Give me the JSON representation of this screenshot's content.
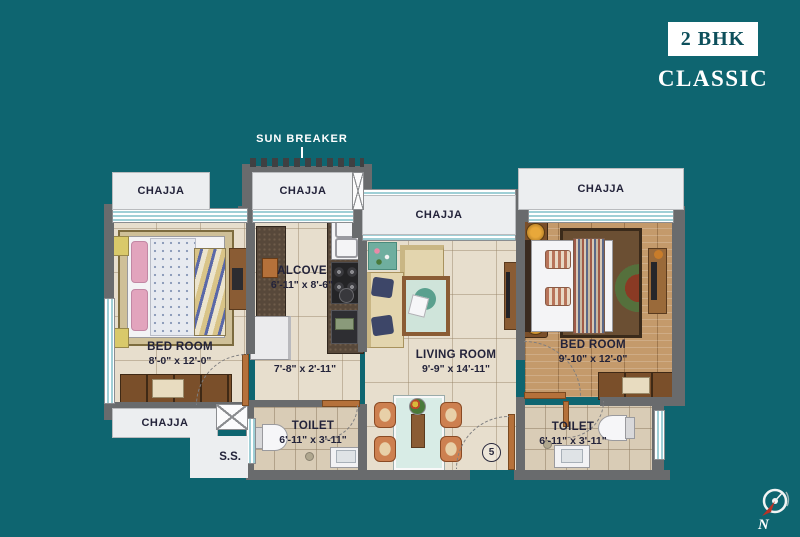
{
  "header": {
    "badge": "2 BHK",
    "subtitle": "CLASSIC"
  },
  "labels": {
    "chajja": "CHAJJA",
    "sun_breaker": "SUN BREAKER",
    "ss": "S.S.",
    "door_number": "5",
    "north": "N"
  },
  "rooms": {
    "bedroom_left": {
      "name": "BED ROOM",
      "size": "8'-0\" x 12'-0\""
    },
    "alcove": {
      "name": "ALCOVE",
      "size": "6'-11\" x 8'-6\""
    },
    "passage": {
      "size": "7'-8\" x 2'-11\""
    },
    "living_room": {
      "name": "LIVING ROOM",
      "size": "9'-9\" x 14'-11\""
    },
    "bedroom_right": {
      "name": "BED ROOM",
      "size": "9'-10\" x 12'-0\""
    },
    "toilet_left": {
      "name": "TOILET",
      "size": "6'-11\" x 3'-11\""
    },
    "toilet_right": {
      "name": "TOILET",
      "size": "6'-11\" x 3'-11\""
    }
  },
  "colors": {
    "background": "#0e6570",
    "title_text": "#0d4f5b",
    "wall": "#696b6d",
    "floor_tile": "#e7decd",
    "wood_floor": "#c49a6b",
    "chajja_panel": "#eceef0",
    "window_stripe": "#9fcfd6",
    "door_frame": "#b5713a",
    "compass_arrow": "#b83226"
  }
}
